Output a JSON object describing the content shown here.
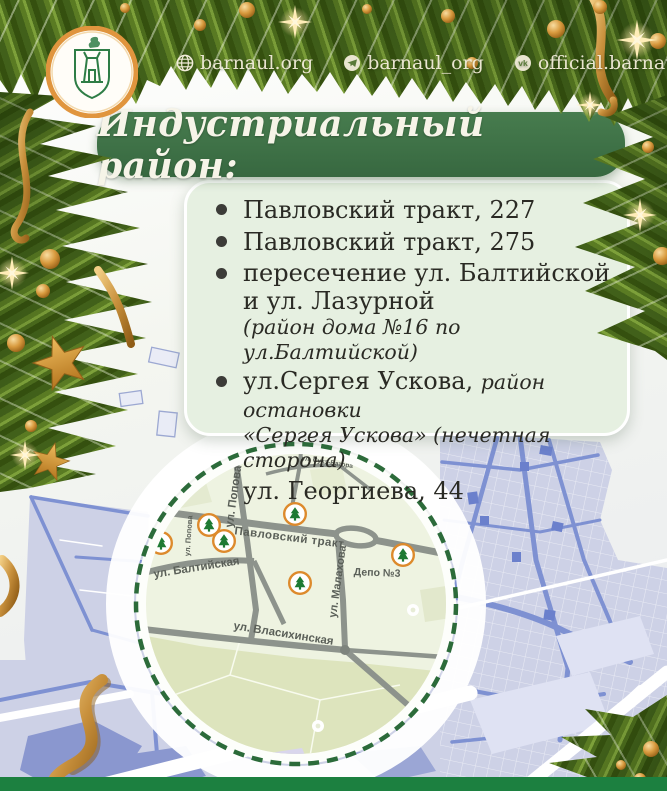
{
  "header": {
    "socials": [
      {
        "icon": "globe-icon",
        "label": "barnaul.org"
      },
      {
        "icon": "telegram-icon",
        "label": "barnaul_org"
      },
      {
        "icon": "vk-icon",
        "label": "official.barnaul"
      }
    ]
  },
  "banner": {
    "title": "Индустриальный район:"
  },
  "locations": {
    "items": [
      {
        "text": "Павловский тракт, 227"
      },
      {
        "text": "Павловский тракт, 275"
      },
      {
        "line1": "пересечение ул. Балтийской",
        "line2": "и ул. Лазурной",
        "note": "(район дома №16 по ул.Балтийской)"
      },
      {
        "main": "ул.Сергея Ускова,",
        "note_inline": "район остановки",
        "note_line2": "«Сергея Ускова» (нечетная сторона)"
      },
      {
        "text": "ул. Георгиева, 44"
      }
    ]
  },
  "map": {
    "labels": {
      "popova": "ул. Попова",
      "popova_small": "ул. Попова",
      "pavlovsky": "Павловский тракт",
      "baltiyskaya": "ул. Балтийская",
      "malakhova": "ул. Малахова",
      "vlasikhinskaya": "ул. Власихинская",
      "sukhe_batora": "ул. Сухэ-Батора",
      "depot": "Депо №3"
    },
    "marker_icon": "tree-icon",
    "markers_count": 6
  },
  "colors": {
    "banner_green": "#3f7347",
    "card_bg": "#e6f0e1",
    "footer_green": "#1c8040",
    "marker_ring_orange": "#dd8a2c",
    "gold": "#d9a147",
    "map_border_green": "#2c6b3a",
    "map_roads_gray": "#8d938c",
    "bg_map_lavender": "#cdd1e6",
    "bg_map_roads_blue": "#7e91d2"
  }
}
